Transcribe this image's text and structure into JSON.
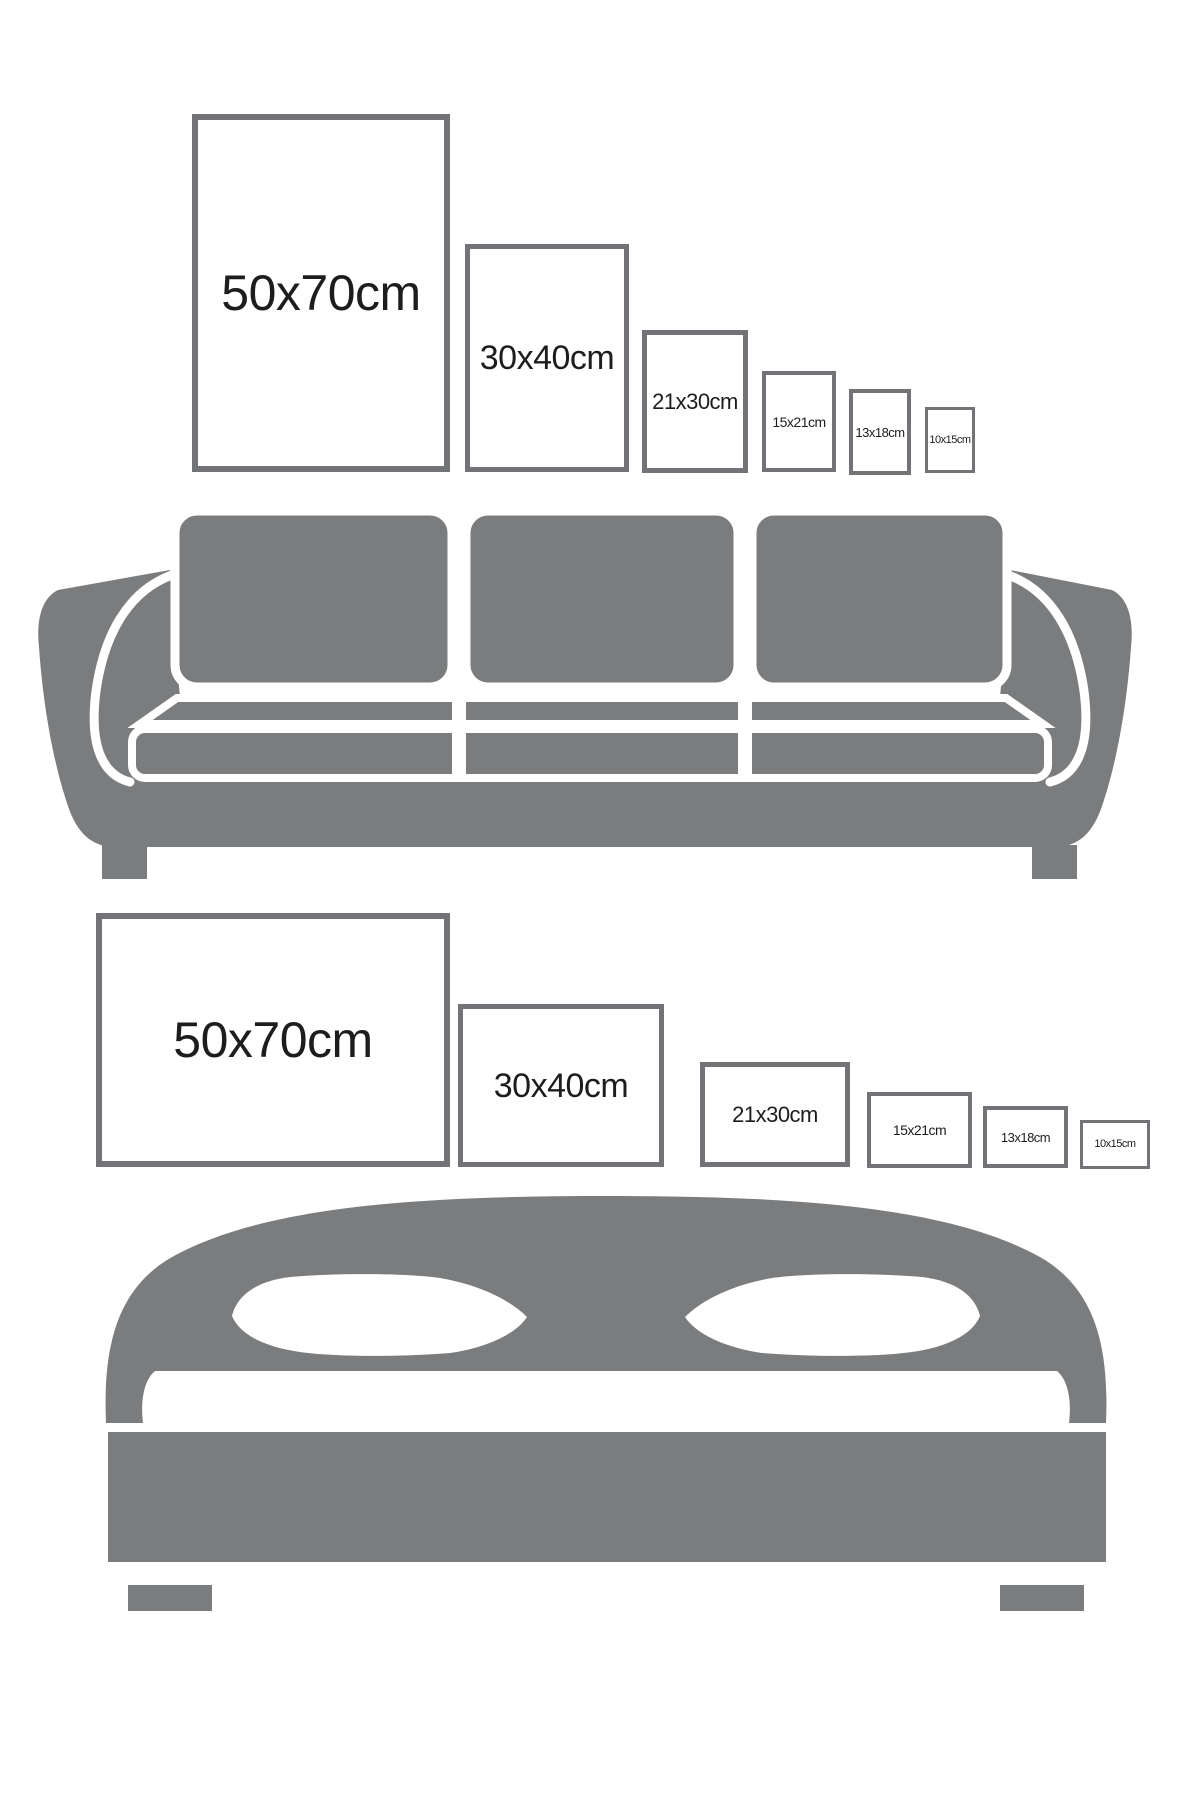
{
  "page": {
    "width": 1200,
    "height": 1800,
    "background": "#ffffff"
  },
  "colors": {
    "frame_border": "#717376",
    "frame_fill": "#ffffff",
    "furniture": "#7a7c7e",
    "label_text": "#1d1d1d",
    "background": "#ffffff"
  },
  "sections": [
    {
      "id": "portrait-row-sofa",
      "furniture": "sofa",
      "orientation": "portrait",
      "frames": [
        {
          "label": "50x70cm",
          "size_cm": "50x70",
          "box": {
            "x": 192,
            "y": 114,
            "w": 258,
            "h": 358
          },
          "border": 6,
          "font": 50
        },
        {
          "label": "30x40cm",
          "size_cm": "30x40",
          "box": {
            "x": 465,
            "y": 244,
            "w": 164,
            "h": 228
          },
          "border": 5,
          "font": 34
        },
        {
          "label": "21x30cm",
          "size_cm": "21x30",
          "box": {
            "x": 642,
            "y": 330,
            "w": 106,
            "h": 143
          },
          "border": 5,
          "font": 22
        },
        {
          "label": "15x21cm",
          "size_cm": "15x21",
          "box": {
            "x": 762,
            "y": 371,
            "w": 74,
            "h": 101
          },
          "border": 4,
          "font": 14
        },
        {
          "label": "13x18cm",
          "size_cm": "13x18",
          "box": {
            "x": 849,
            "y": 389,
            "w": 62,
            "h": 86
          },
          "border": 4,
          "font": 13
        },
        {
          "label": "10x15cm",
          "size_cm": "10x15",
          "box": {
            "x": 925,
            "y": 407,
            "w": 50,
            "h": 66
          },
          "border": 3,
          "font": 11
        }
      ]
    },
    {
      "id": "landscape-row-bed",
      "furniture": "bed",
      "orientation": "landscape",
      "frames": [
        {
          "label": "50x70cm",
          "size_cm": "50x70",
          "box": {
            "x": 96,
            "y": 913,
            "w": 354,
            "h": 254
          },
          "border": 6,
          "font": 50
        },
        {
          "label": "30x40cm",
          "size_cm": "30x40",
          "box": {
            "x": 458,
            "y": 1004,
            "w": 206,
            "h": 163
          },
          "border": 5,
          "font": 34
        },
        {
          "label": "21x30cm",
          "size_cm": "21x30",
          "box": {
            "x": 700,
            "y": 1062,
            "w": 150,
            "h": 105
          },
          "border": 5,
          "font": 22
        },
        {
          "label": "15x21cm",
          "size_cm": "15x21",
          "box": {
            "x": 867,
            "y": 1092,
            "w": 105,
            "h": 76
          },
          "border": 4,
          "font": 14
        },
        {
          "label": "13x18cm",
          "size_cm": "13x18",
          "box": {
            "x": 983,
            "y": 1106,
            "w": 85,
            "h": 62
          },
          "border": 4,
          "font": 13
        },
        {
          "label": "10x15cm",
          "size_cm": "10x15",
          "box": {
            "x": 1080,
            "y": 1120,
            "w": 70,
            "h": 49
          },
          "border": 3,
          "font": 11
        }
      ]
    }
  ]
}
